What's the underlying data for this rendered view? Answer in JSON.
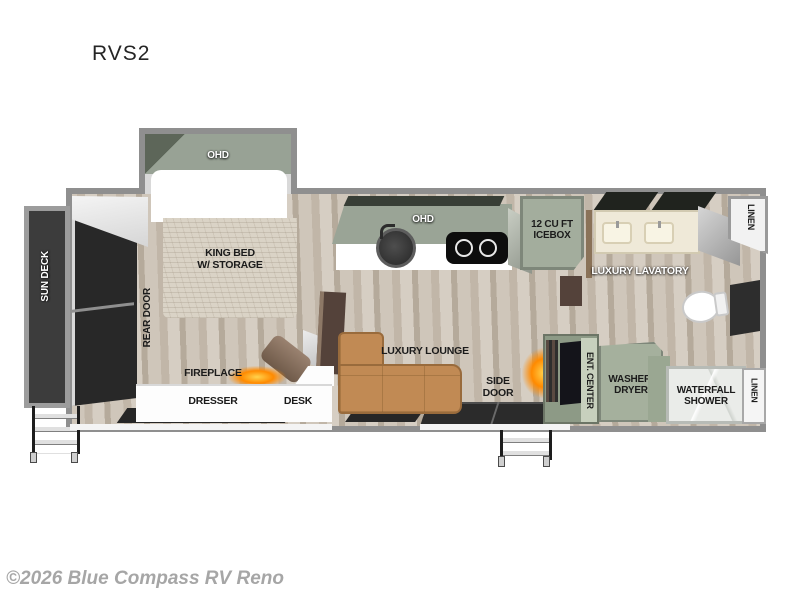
{
  "title": "RVS2",
  "watermark": "©2026 Blue Compass RV Reno",
  "rooms": {
    "bedroom": {
      "ohd": "OHD",
      "bed": "KING BED\nW/ STORAGE",
      "rear_door": "REAR DOOR",
      "fireplace": "FIREPLACE",
      "dresser": "DRESSER",
      "desk": "DESK"
    },
    "exterior": {
      "sun_deck": "SUN DECK",
      "side_door": "SIDE\nDOOR"
    },
    "kitchen": {
      "ohd": "OHD",
      "icebox": "12 CU FT\nICEBOX"
    },
    "bathroom": {
      "lavatory": "LUXURY LAVATORY",
      "linen_top": "LINEN",
      "washer_dryer": "WASHER/\nDRYER",
      "shower": "WATERFALL\nSHOWER",
      "linen_bottom": "LINEN"
    },
    "living": {
      "lounge": "LUXURY LOUNGE",
      "ent_center": "ENT. CENTER"
    }
  },
  "colors": {
    "wall_gray": "#8f8f8f",
    "wood_floor": "#c8bdb0",
    "cabinet_green": "#9aa496",
    "appliance_green": "#a5b09d",
    "sofa_tan": "#c18a54",
    "deck_dark": "#3c3c3c",
    "glow_orange": "#ff8a00",
    "counter_white": "#ffffff"
  }
}
